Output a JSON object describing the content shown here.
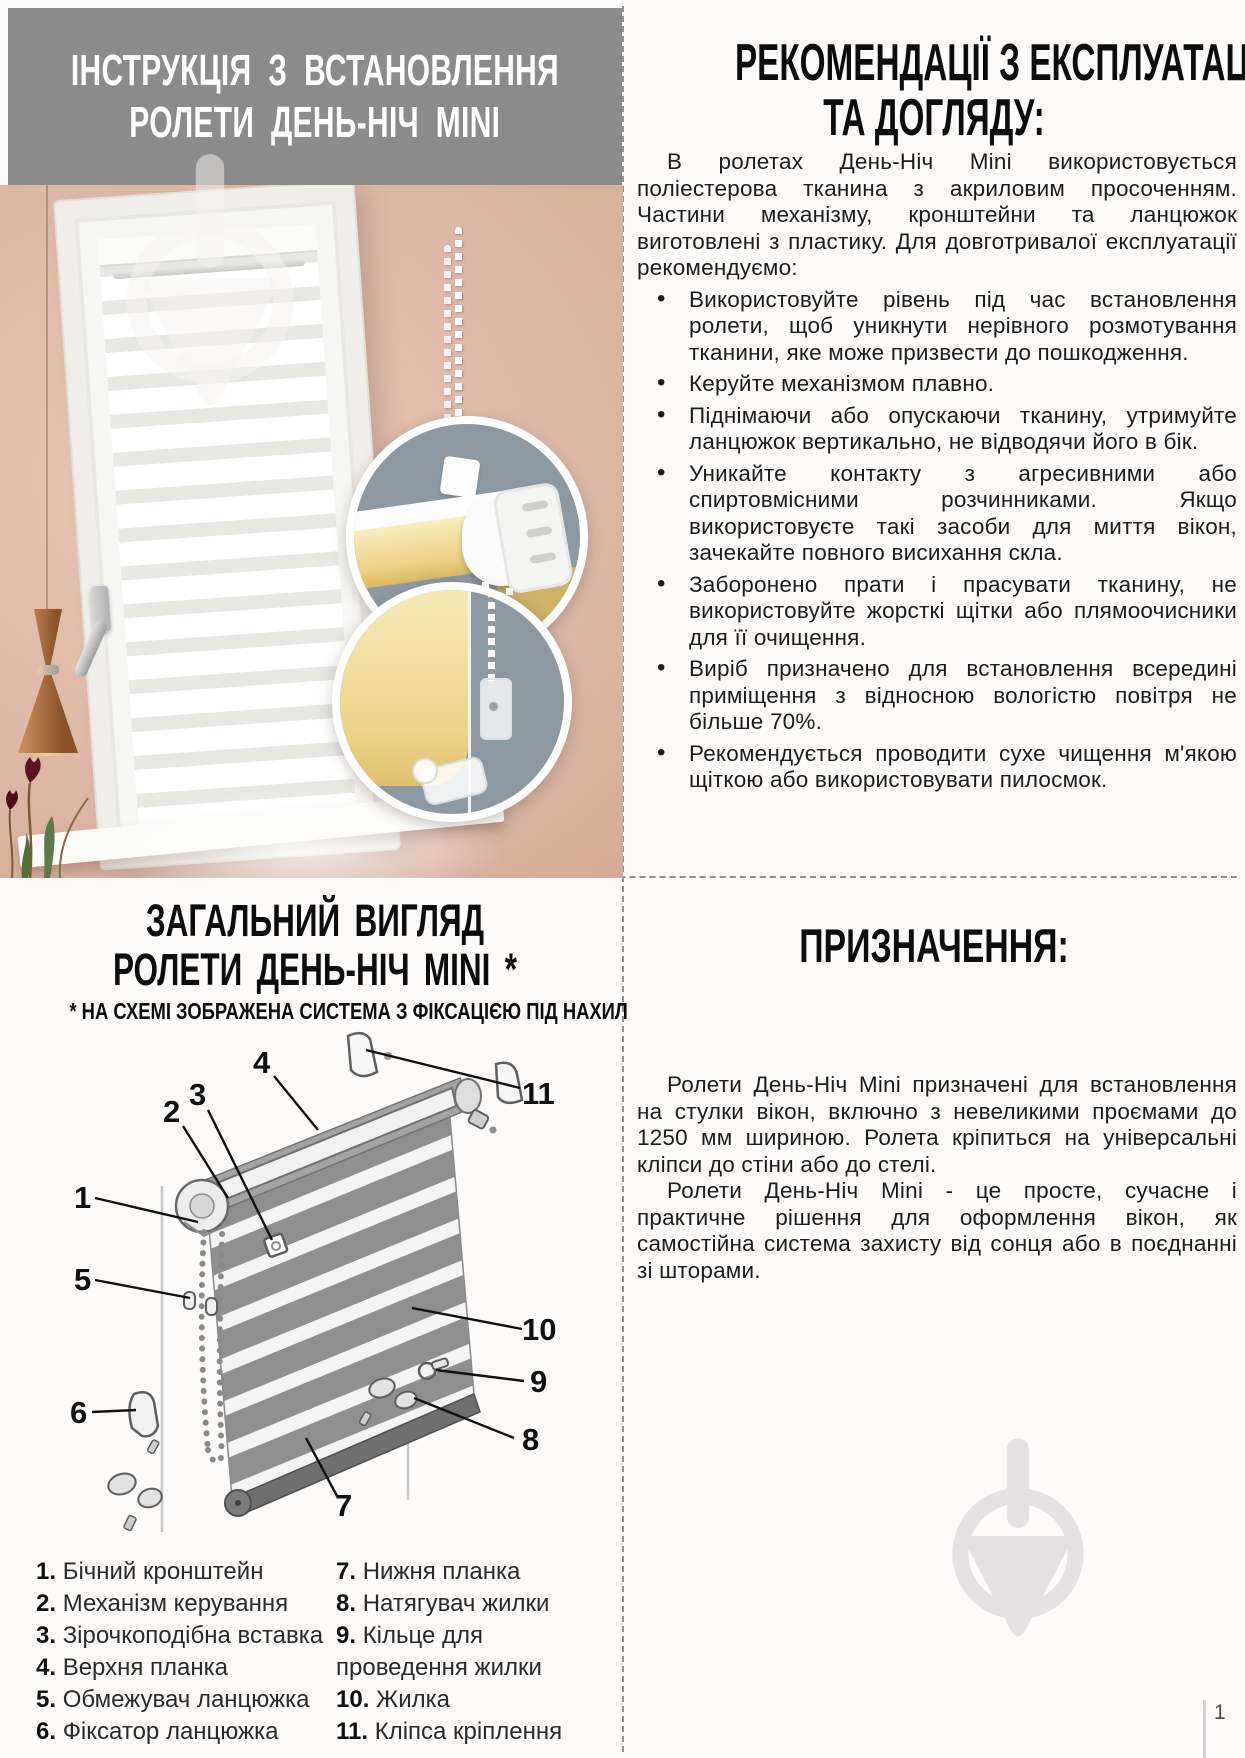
{
  "header": {
    "line1": "ІНСТРУКЦІЯ З ВСТАНОВЛЕННЯ",
    "line2": "РОЛЕТИ ДЕНЬ-НІЧ MINI"
  },
  "recommendations": {
    "title_line1": "РЕКОМЕНДАЦІЇ З ЕКСПЛУАТАЦІЇ",
    "title_line2": "ТА ДОГЛЯДУ:",
    "intro": "В ролетах День-Ніч Mini використовується поліестерова тканина з акриловим просоченням. Частини механізму, кронштейни та ланцюжок виготовлені з пластику. Для довготривалої експлуатації рекомендуємо:",
    "bullets": [
      "Використовуйте рівень під час встановлення ролети, щоб уникнути нерівного розмотування тканини, яке може призвести до пошкодження.",
      "Керуйте механізмом плавно.",
      "Піднімаючи або опускаючи тканину, утримуйте ланцюжок вертикально, не відводячи його в бік.",
      "Уникайте контакту з агресивними або спиртовмісними розчинниками. Якщо використовуєте такі засоби для миття вікон, зачекайте повного висихання скла.",
      "Заборонено прати і прасувати тканину, не використовуйте жорсткі щітки або плямоочисники для її очищення.",
      "Виріб призначено для встановлення всередині приміщення з відносною вологістю повітря не більше 70%.",
      "Рекомендується проводити сухе чищення м'якою щіткою або використовувати пилосмок."
    ]
  },
  "overview": {
    "title_line1": "ЗАГАЛЬНИЙ ВИГЛЯД",
    "title_line2": "РОЛЕТИ ДЕНЬ-НІЧ MINI *",
    "note": "* НА СХЕМІ ЗОБРАЖЕНА СИСТЕМА З ФІКСАЦІЄЮ ПІД НАХИЛ",
    "callouts": [
      "1",
      "2",
      "3",
      "4",
      "5",
      "6",
      "7",
      "8",
      "9",
      "10",
      "11"
    ],
    "parts_left": [
      {
        "num": "1.",
        "label": "Бічний кронштейн"
      },
      {
        "num": "2.",
        "label": "Механізм керування"
      },
      {
        "num": "3.",
        "label": "Зірочкоподібна вставка"
      },
      {
        "num": "4.",
        "label": "Верхня планка"
      },
      {
        "num": "5.",
        "label": "Обмежувач ланцюжка"
      },
      {
        "num": "6.",
        "label": "Фіксатор ланцюжка"
      }
    ],
    "parts_right": [
      {
        "num": "7.",
        "label": "Нижня планка"
      },
      {
        "num": "8.",
        "label": "Натягувач жилки"
      },
      {
        "num": "9.",
        "label": "Кільце для проведення жилки"
      },
      {
        "num": "10.",
        "label": "Жилка"
      },
      {
        "num": "11.",
        "label": "Кліпса кріплення"
      }
    ]
  },
  "purpose": {
    "title": "ПРИЗНАЧЕННЯ:",
    "paragraph1": "Ролети День-Ніч Mini призначені для встановлення на стулки вікон, включно з невеликими проємами до 1250 мм шириною. Ролета кріпиться на універсальні кліпси до стіни або до стелі.",
    "paragraph2": "Ролети День-Ніч Mini - це просте, сучасне і практичне рішення для оформлення вікон, як самостійна система захисту від сонця або в поєднанні зі шторами."
  },
  "page": {
    "number": "1"
  },
  "colors": {
    "header_band": "#8b8b8b",
    "text": "#1b1b1b",
    "wall_pink": "#ddb8a7",
    "inset_gray": "#8c98a2",
    "blind_yellow": "#f2dd9c",
    "copper": "#b5784a",
    "watermark_gray": "#e4e2e2"
  }
}
